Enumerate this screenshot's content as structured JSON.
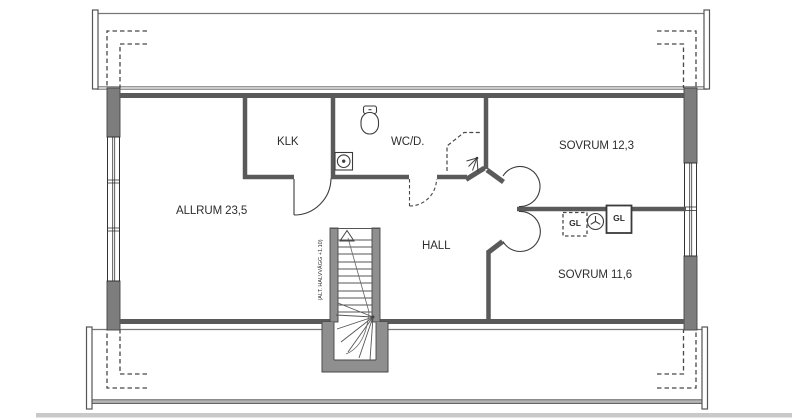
{
  "rooms": {
    "allrum": "ALLRUM 23,5",
    "klk": "KLK",
    "wc": "WC/D.",
    "sovrum_1": "SOVRUM 12,3",
    "hall": "HALL",
    "sovrum_2": "SOVRUM 11,6"
  },
  "closets": {
    "gl_left": "GL",
    "gl_right": "GL"
  },
  "stair": {
    "note": "(ALT. HALVVÄGG +1.10)"
  },
  "colors": {
    "exterior_wall_fill": "#7d7d7d",
    "interior_wall": "#5a5a5a",
    "outline": "#3c3c3c",
    "stair_wall_fill": "#8f8f8f",
    "band_line": "#777777",
    "bottom_strip": "#c9c9c9"
  }
}
